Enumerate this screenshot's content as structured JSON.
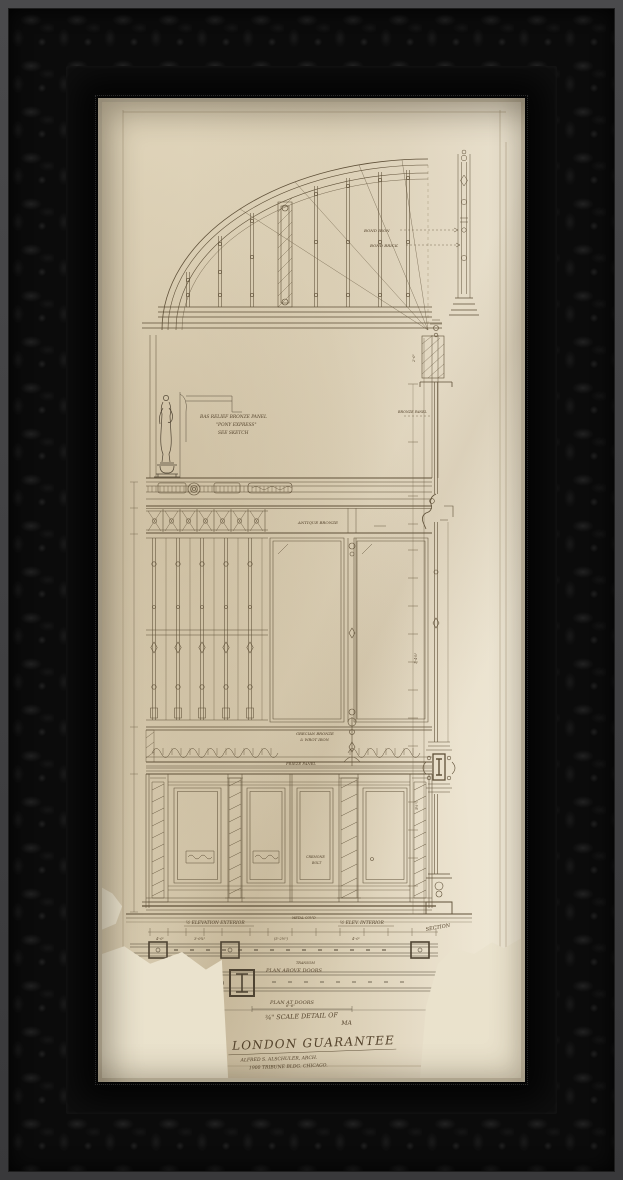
{
  "artwork": {
    "type": "architectural drawing, pencil and ink on aged paper, ornate black frame",
    "labels": {
      "bas_relief_1": "BAS RELIEF BRONZE PANEL",
      "bas_relief_2": "\"PONY EXPRESS\"",
      "bas_relief_3": "SEE SKETCH",
      "antique_bronze": "ANTIQUE BRONZE",
      "grecian_bronze_1": "GRECIAN BRONZE",
      "grecian_bronze_2": "& WROT IRON",
      "frieze_panel": "FRIEZE PANEL",
      "cremone_1": "CREMONE",
      "cremone_2": "BOLT",
      "elev_exterior": "½ ELEVATION EXTERIOR",
      "metal_covd": "METAL COV'D",
      "elev_interior": "½ ELEV. INTERIOR",
      "section": "SECTION",
      "transom": "TRANSOM",
      "plan_above_doors": "PLAN ABOVE DOORS",
      "plan_at_doors": "PLAN AT DOORS",
      "plan_dim": "6'-6\"",
      "scale_line1": "¾\" SCALE DETAIL OF",
      "scale_line2": "MA",
      "title": "LONDON GUARANTEE",
      "architect": "ALFRED S. ALSCHULER, ARCH.",
      "address": "1900 TRIBUNE BLDG. CHICAGO.",
      "bond_iron": "BOND IRON",
      "bond_brick": "BOND BRICK",
      "bronze_panel": "BRONZE PANEL",
      "rough_dim": "2'-0\""
    },
    "dims": [
      "4'-0\"",
      "3'-0¾\"",
      "(5'-2½\")",
      "4'-0\"",
      "1'-4⅛\"",
      "5½\""
    ],
    "colors": {
      "frame": "#0b0b0b",
      "paper": "#e6dcc4",
      "paper_torn_backing": "#f3eddd",
      "ink": "#5f5038",
      "fillet": "#cfc5ae"
    }
  }
}
